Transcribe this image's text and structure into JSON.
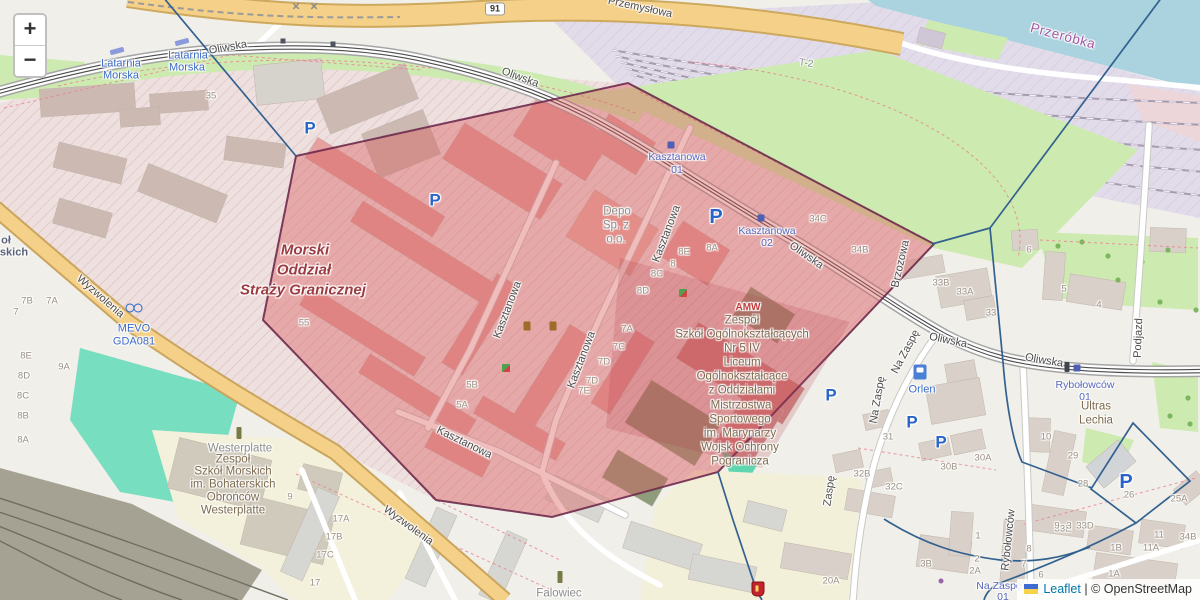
{
  "app": {
    "name": "leaflet-map-view"
  },
  "controls": {
    "zoom_in": "+",
    "zoom_out": "−"
  },
  "attribution": {
    "flag": "ukraine-flag",
    "leaflet": "Leaflet",
    "sep": " | ",
    "osm": "© OpenStreetMap"
  },
  "colors": {
    "overlay_fill": "#d95858",
    "overlay_stroke": "#6e2a4c",
    "boundary_blue": "#33618f",
    "water": "#aad3df",
    "grass": "#cdebb0",
    "pitch": "#78dec0",
    "military_pink": "#efe0e0",
    "road_yellow": "#f5d089",
    "transit_blue": "#5868bc",
    "link_blue": "#0078A8"
  },
  "labels": [
    {
      "t": "Oliwska",
      "x": 228,
      "y": 48,
      "r": -10,
      "c": "st"
    },
    {
      "t": "Oliwska",
      "x": 520,
      "y": 78,
      "r": 20,
      "c": "st"
    },
    {
      "t": "Oliwska",
      "x": 806,
      "y": 256,
      "r": 35,
      "c": "st"
    },
    {
      "t": "Oliwska",
      "x": 948,
      "y": 341,
      "r": 12,
      "c": "st"
    },
    {
      "t": "Oliwska",
      "x": 1044,
      "y": 361,
      "r": 10,
      "c": "st"
    },
    {
      "t": "Przemysłowa",
      "x": 640,
      "y": 8,
      "r": 12,
      "c": "st"
    },
    {
      "t": "Wyzwolenia",
      "x": 100,
      "y": 297,
      "r": 41,
      "c": "st"
    },
    {
      "t": "Wyzwolenia",
      "x": 408,
      "y": 526,
      "r": 36,
      "c": "st"
    },
    {
      "t": "Kasztanowa",
      "x": 508,
      "y": 310,
      "r": -69,
      "c": "st"
    },
    {
      "t": "Kasztanowa",
      "x": 582,
      "y": 360,
      "r": -69,
      "c": "st"
    },
    {
      "t": "Kasztanowa",
      "x": 667,
      "y": 234,
      "r": -69,
      "c": "st"
    },
    {
      "t": "Kasztanowa",
      "x": 464,
      "y": 443,
      "r": 26,
      "c": "st"
    },
    {
      "t": "Na Zaspę",
      "x": 906,
      "y": 352,
      "r": -62,
      "c": "st"
    },
    {
      "t": "Na Zaspę",
      "x": 878,
      "y": 400,
      "r": -80,
      "c": "st"
    },
    {
      "t": "Zaspę",
      "x": 830,
      "y": 491,
      "r": -82,
      "c": "st"
    },
    {
      "t": "Rybołowców",
      "x": 1009,
      "y": 540,
      "r": -84,
      "c": "st"
    },
    {
      "t": "Podjazd",
      "x": 1139,
      "y": 338,
      "r": -88,
      "c": "st"
    },
    {
      "t": "Brzozowa",
      "x": 901,
      "y": 264,
      "r": -77,
      "c": "st"
    },
    {
      "t": "T-2",
      "x": 806,
      "y": 64,
      "r": 8,
      "c": "gry2"
    },
    {
      "t": "Przeróbka",
      "x": 1063,
      "y": 36,
      "r": 15,
      "c": "plc"
    },
    {
      "t": "Latarnia",
      "x": 121,
      "y": 64,
      "r": 0,
      "c": "poi"
    },
    {
      "t": "Morska",
      "x": 121,
      "y": 76,
      "r": 0,
      "c": "poi"
    },
    {
      "t": "Latarnia",
      "x": 188,
      "y": 56,
      "r": 0,
      "c": "poi"
    },
    {
      "t": "Morska",
      "x": 187,
      "y": 68,
      "r": 0,
      "c": "poi"
    },
    {
      "t": "MEVO",
      "x": 134,
      "y": 329,
      "r": 0,
      "c": "poi"
    },
    {
      "t": "GDA081",
      "x": 134,
      "y": 342,
      "r": 0,
      "c": "poi"
    },
    {
      "t": "Orlen",
      "x": 922,
      "y": 390,
      "r": 0,
      "c": "poi"
    },
    {
      "t": "Kasztanowa",
      "x": 677,
      "y": 157,
      "r": 0,
      "c": "trn"
    },
    {
      "t": "01",
      "x": 677,
      "y": 170,
      "r": 0,
      "c": "trn"
    },
    {
      "t": "Kasztanowa",
      "x": 767,
      "y": 231,
      "r": 0,
      "c": "trn"
    },
    {
      "t": "02",
      "x": 767,
      "y": 243,
      "r": 0,
      "c": "trn"
    },
    {
      "t": "Rybołowców",
      "x": 1085,
      "y": 385,
      "r": 0,
      "c": "trn"
    },
    {
      "t": "01",
      "x": 1085,
      "y": 397,
      "r": 0,
      "c": "trn"
    },
    {
      "t": "Na Zaspę",
      "x": 999,
      "y": 586,
      "r": 0,
      "c": "trn"
    },
    {
      "t": "01",
      "x": 1003,
      "y": 597,
      "r": 0,
      "c": "trn"
    },
    {
      "t": "Morski",
      "x": 305,
      "y": 250,
      "r": 0,
      "c": "mil"
    },
    {
      "t": "Oddział",
      "x": 304,
      "y": 270,
      "r": 0,
      "c": "mil"
    },
    {
      "t": "Straży Granicznej",
      "x": 303,
      "y": 290,
      "r": 0,
      "c": "mil"
    },
    {
      "t": "Depo",
      "x": 617,
      "y": 212,
      "r": 0,
      "c": "gry"
    },
    {
      "t": "Sp. z",
      "x": 616,
      "y": 226,
      "r": 0,
      "c": "gry"
    },
    {
      "t": "o.o.",
      "x": 616,
      "y": 240,
      "r": 0,
      "c": "gry"
    },
    {
      "t": "Westerplatte",
      "x": 240,
      "y": 449,
      "r": 0,
      "c": "gry"
    },
    {
      "t": "Falowiec",
      "x": 559,
      "y": 594,
      "r": 0,
      "c": "gry"
    },
    {
      "t": "AMW",
      "x": 748,
      "y": 308,
      "r": 0,
      "c": "red"
    },
    {
      "t": "Zespół",
      "x": 742,
      "y": 321,
      "r": 0,
      "c": "sch"
    },
    {
      "t": "Szkół Ogólnokształcących",
      "x": 742,
      "y": 335,
      "r": 0,
      "c": "sch"
    },
    {
      "t": "Nr 5 IV",
      "x": 742,
      "y": 349,
      "r": 0,
      "c": "sch"
    },
    {
      "t": "Liceum",
      "x": 742,
      "y": 363,
      "r": 0,
      "c": "sch"
    },
    {
      "t": "Ogólnokształcące",
      "x": 742,
      "y": 377,
      "r": 0,
      "c": "sch"
    },
    {
      "t": "z Oddziałami",
      "x": 742,
      "y": 391,
      "r": 0,
      "c": "sch"
    },
    {
      "t": "Mistrzostwa",
      "x": 741,
      "y": 406,
      "r": 0,
      "c": "sch"
    },
    {
      "t": "Sportowego",
      "x": 740,
      "y": 420,
      "r": 0,
      "c": "sch"
    },
    {
      "t": "im. Marynarzy",
      "x": 740,
      "y": 434,
      "r": 0,
      "c": "sch"
    },
    {
      "t": "Wojsk Ochrony",
      "x": 740,
      "y": 448,
      "r": 0,
      "c": "sch"
    },
    {
      "t": "Pogranicza",
      "x": 740,
      "y": 462,
      "r": 0,
      "c": "sch"
    },
    {
      "t": "Zespół",
      "x": 233,
      "y": 460,
      "r": 0,
      "c": "sch"
    },
    {
      "t": "Szkół Morskich",
      "x": 233,
      "y": 472,
      "r": 0,
      "c": "sch"
    },
    {
      "t": "im. Bohaterskich",
      "x": 233,
      "y": 485,
      "r": 0,
      "c": "sch"
    },
    {
      "t": "Obrońców",
      "x": 233,
      "y": 498,
      "r": 0,
      "c": "sch"
    },
    {
      "t": "Westerplatte",
      "x": 233,
      "y": 511,
      "r": 0,
      "c": "sch"
    },
    {
      "t": "Ultras",
      "x": 1096,
      "y": 407,
      "r": 0,
      "c": "sch"
    },
    {
      "t": "Lechia",
      "x": 1096,
      "y": 421,
      "r": 0,
      "c": "sch"
    },
    {
      "t": "oł",
      "x": 6,
      "y": 241,
      "r": 0,
      "c": "frag"
    },
    {
      "t": "skich",
      "x": 14,
      "y": 253,
      "r": 0,
      "c": "frag"
    },
    {
      "t": "91",
      "x": 495,
      "y": 9,
      "r": 0,
      "c": "shield"
    },
    {
      "t": "×",
      "x": 296,
      "y": 6,
      "r": 0,
      "c": "xmk"
    },
    {
      "t": "×",
      "x": 314,
      "y": 6,
      "r": 0,
      "c": "xmk"
    },
    {
      "t": "P",
      "x": 310,
      "y": 128,
      "r": 0,
      "c": "pk"
    },
    {
      "t": "P",
      "x": 435,
      "y": 200,
      "r": 0,
      "c": "pk"
    },
    {
      "t": "P",
      "x": 716,
      "y": 217,
      "r": 0,
      "c": "pk pklg"
    },
    {
      "t": "P",
      "x": 831,
      "y": 395,
      "r": 0,
      "c": "pk"
    },
    {
      "t": "P",
      "x": 912,
      "y": 422,
      "r": 0,
      "c": "pk"
    },
    {
      "t": "P",
      "x": 941,
      "y": 442,
      "r": 0,
      "c": "pk"
    },
    {
      "t": "P",
      "x": 1126,
      "y": 482,
      "r": 0,
      "c": "pk pklg"
    },
    {
      "t": "35",
      "x": 211,
      "y": 96,
      "r": 0,
      "c": "num"
    },
    {
      "t": "55",
      "x": 304,
      "y": 323,
      "r": 0,
      "c": "num"
    },
    {
      "t": "7B",
      "x": 27,
      "y": 301,
      "r": 0,
      "c": "num"
    },
    {
      "t": "7A",
      "x": 52,
      "y": 301,
      "r": 0,
      "c": "num"
    },
    {
      "t": "7",
      "x": 16,
      "y": 312,
      "r": 0,
      "c": "num"
    },
    {
      "t": "8E",
      "x": 26,
      "y": 356,
      "r": 0,
      "c": "num"
    },
    {
      "t": "9A",
      "x": 64,
      "y": 367,
      "r": 0,
      "c": "num"
    },
    {
      "t": "8D",
      "x": 24,
      "y": 376,
      "r": 0,
      "c": "num"
    },
    {
      "t": "8C",
      "x": 23,
      "y": 396,
      "r": 0,
      "c": "num"
    },
    {
      "t": "8B",
      "x": 23,
      "y": 416,
      "r": 0,
      "c": "num"
    },
    {
      "t": "8A",
      "x": 23,
      "y": 440,
      "r": 0,
      "c": "num"
    },
    {
      "t": "8A",
      "x": 712,
      "y": 248,
      "r": 0,
      "c": "num"
    },
    {
      "t": "8E",
      "x": 684,
      "y": 252,
      "r": 0,
      "c": "num"
    },
    {
      "t": "8",
      "x": 673,
      "y": 264,
      "r": 0,
      "c": "num"
    },
    {
      "t": "8C",
      "x": 657,
      "y": 274,
      "r": 0,
      "c": "num"
    },
    {
      "t": "8D",
      "x": 643,
      "y": 291,
      "r": 0,
      "c": "num"
    },
    {
      "t": "7A",
      "x": 627,
      "y": 329,
      "r": 0,
      "c": "num"
    },
    {
      "t": "7C",
      "x": 619,
      "y": 347,
      "r": 0,
      "c": "num"
    },
    {
      "t": "7D",
      "x": 604,
      "y": 362,
      "r": 0,
      "c": "num"
    },
    {
      "t": "7D",
      "x": 592,
      "y": 381,
      "r": 0,
      "c": "num"
    },
    {
      "t": "7E",
      "x": 584,
      "y": 391,
      "r": 0,
      "c": "num"
    },
    {
      "t": "5B",
      "x": 472,
      "y": 385,
      "r": 0,
      "c": "num"
    },
    {
      "t": "5A",
      "x": 462,
      "y": 405,
      "r": 0,
      "c": "num"
    },
    {
      "t": "34C",
      "x": 818,
      "y": 219,
      "r": 0,
      "c": "num"
    },
    {
      "t": "34B",
      "x": 860,
      "y": 250,
      "r": 0,
      "c": "num"
    },
    {
      "t": "33B",
      "x": 941,
      "y": 283,
      "r": 0,
      "c": "num"
    },
    {
      "t": "33A",
      "x": 965,
      "y": 292,
      "r": 0,
      "c": "num"
    },
    {
      "t": "33",
      "x": 991,
      "y": 313,
      "r": 0,
      "c": "num"
    },
    {
      "t": "6",
      "x": 1029,
      "y": 250,
      "r": 0,
      "c": "num"
    },
    {
      "t": "5",
      "x": 1064,
      "y": 289,
      "r": 0,
      "c": "num"
    },
    {
      "t": "4",
      "x": 1099,
      "y": 305,
      "r": 0,
      "c": "num"
    },
    {
      "t": "31",
      "x": 888,
      "y": 437,
      "r": 0,
      "c": "num"
    },
    {
      "t": "30A",
      "x": 983,
      "y": 458,
      "r": 0,
      "c": "num"
    },
    {
      "t": "30B",
      "x": 949,
      "y": 467,
      "r": 0,
      "c": "num"
    },
    {
      "t": "32B",
      "x": 862,
      "y": 474,
      "r": 0,
      "c": "num"
    },
    {
      "t": "32C",
      "x": 894,
      "y": 487,
      "r": 0,
      "c": "num"
    },
    {
      "t": "10",
      "x": 1046,
      "y": 437,
      "r": 0,
      "c": "num"
    },
    {
      "t": "29",
      "x": 1073,
      "y": 456,
      "r": 0,
      "c": "num"
    },
    {
      "t": "28",
      "x": 1083,
      "y": 484,
      "r": 0,
      "c": "num"
    },
    {
      "t": "26",
      "x": 1129,
      "y": 495,
      "r": 0,
      "c": "num"
    },
    {
      "t": "25A",
      "x": 1179,
      "y": 499,
      "r": 0,
      "c": "num"
    },
    {
      "t": "33E",
      "x": 1063,
      "y": 529,
      "r": 0,
      "c": "num"
    },
    {
      "t": "33D",
      "x": 1085,
      "y": 526,
      "r": 0,
      "c": "num"
    },
    {
      "t": "1B",
      "x": 1116,
      "y": 548,
      "r": 0,
      "c": "num"
    },
    {
      "t": "1A",
      "x": 1114,
      "y": 574,
      "r": 0,
      "c": "num"
    },
    {
      "t": "11A",
      "x": 1151,
      "y": 548,
      "r": 0,
      "c": "num"
    },
    {
      "t": "11",
      "x": 1159,
      "y": 535,
      "r": 0,
      "c": "num"
    },
    {
      "t": "34B",
      "x": 1188,
      "y": 537,
      "r": 0,
      "c": "num"
    },
    {
      "t": "8",
      "x": 1029,
      "y": 549,
      "r": 0,
      "c": "num"
    },
    {
      "t": "7",
      "x": 1024,
      "y": 564,
      "r": 0,
      "c": "num"
    },
    {
      "t": "6",
      "x": 1041,
      "y": 575,
      "r": 0,
      "c": "num"
    },
    {
      "t": "9",
      "x": 1057,
      "y": 526,
      "r": 0,
      "c": "num"
    },
    {
      "t": "3",
      "x": 1069,
      "y": 526,
      "r": 0,
      "c": "num"
    },
    {
      "t": "2",
      "x": 977,
      "y": 559,
      "r": 0,
      "c": "num"
    },
    {
      "t": "2A",
      "x": 975,
      "y": 571,
      "r": 0,
      "c": "num"
    },
    {
      "t": "1",
      "x": 978,
      "y": 536,
      "r": 0,
      "c": "num"
    },
    {
      "t": "3B",
      "x": 926,
      "y": 564,
      "r": 0,
      "c": "num"
    },
    {
      "t": "20A",
      "x": 831,
      "y": 581,
      "r": 0,
      "c": "num"
    },
    {
      "t": "17A",
      "x": 341,
      "y": 519,
      "r": 0,
      "c": "num"
    },
    {
      "t": "17B",
      "x": 334,
      "y": 537,
      "r": 0,
      "c": "num"
    },
    {
      "t": "17C",
      "x": 325,
      "y": 555,
      "r": 0,
      "c": "num"
    },
    {
      "t": "17",
      "x": 315,
      "y": 583,
      "r": 0,
      "c": "num"
    },
    {
      "t": "9",
      "x": 290,
      "y": 497,
      "r": 0,
      "c": "num"
    }
  ],
  "icons": [
    {
      "k": "monument",
      "x": 239,
      "y": 433
    },
    {
      "k": "monument",
      "x": 560,
      "y": 577
    },
    {
      "k": "memorial",
      "x": 527,
      "y": 326
    },
    {
      "k": "memorial",
      "x": 553,
      "y": 326
    },
    {
      "k": "playground",
      "x": 506,
      "y": 368
    },
    {
      "k": "playground",
      "x": 683,
      "y": 293
    },
    {
      "k": "fuel",
      "x": 920,
      "y": 372
    },
    {
      "k": "bike",
      "x": 133,
      "y": 308
    },
    {
      "k": "crest",
      "x": 758,
      "y": 589
    },
    {
      "k": "shelter",
      "x": 283,
      "y": 41
    },
    {
      "k": "shelter",
      "x": 333,
      "y": 44
    },
    {
      "k": "platform",
      "x": 117,
      "y": 51,
      "r": -15
    },
    {
      "k": "platform",
      "x": 182,
      "y": 42,
      "r": -15
    },
    {
      "k": "stop",
      "x": 671,
      "y": 145
    },
    {
      "k": "stop",
      "x": 761,
      "y": 218
    },
    {
      "k": "signal",
      "x": 1067,
      "y": 367
    },
    {
      "k": "stop",
      "x": 1077,
      "y": 368
    },
    {
      "k": "dot",
      "x": 941,
      "y": 581
    }
  ]
}
